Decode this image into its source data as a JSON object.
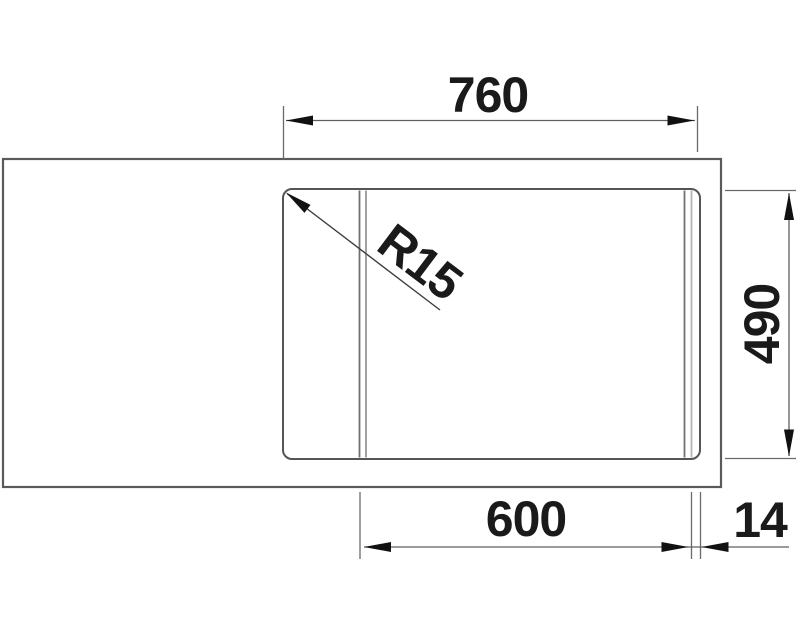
{
  "drawing": {
    "type": "technical-dimension-drawing",
    "subject": "kitchen-sink-top-view",
    "labels": {
      "width_total": "760",
      "depth": "490",
      "bowl_width": "600",
      "rail_width": "14",
      "corner_radius": "R15"
    },
    "colors": {
      "line": "#5a5a5a",
      "thin_line": "#6a6a6a",
      "light_line": "#b5b5b5",
      "arrow": "#111111",
      "text": "#1a1a1a",
      "background": "#ffffff"
    }
  }
}
